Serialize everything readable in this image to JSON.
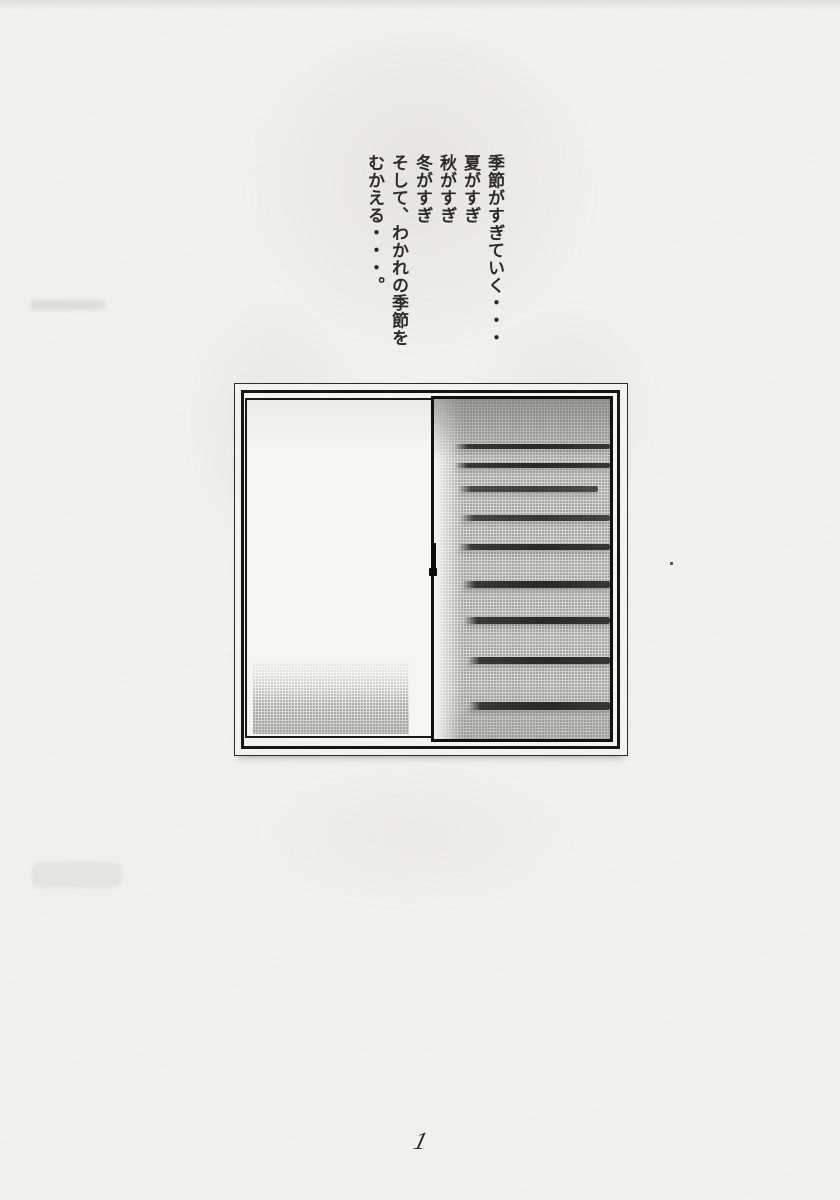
{
  "poem": {
    "lines": [
      "季節がすぎていく・・・",
      "夏がすぎ",
      "秋がすぎ",
      "冬がすぎ",
      "そして、わかれの季節を",
      "むかえる・・・。"
    ]
  },
  "footer": {
    "page_number": "1"
  },
  "illustration": {
    "type": "sliding-window",
    "blind_slat_count": 9
  },
  "colors": {
    "paper": "#f2f1ed",
    "ink": "#2c2a27",
    "window_frame": "#161513",
    "left_glass": "#f6f5f1",
    "right_glass": "#d8d7d3"
  }
}
